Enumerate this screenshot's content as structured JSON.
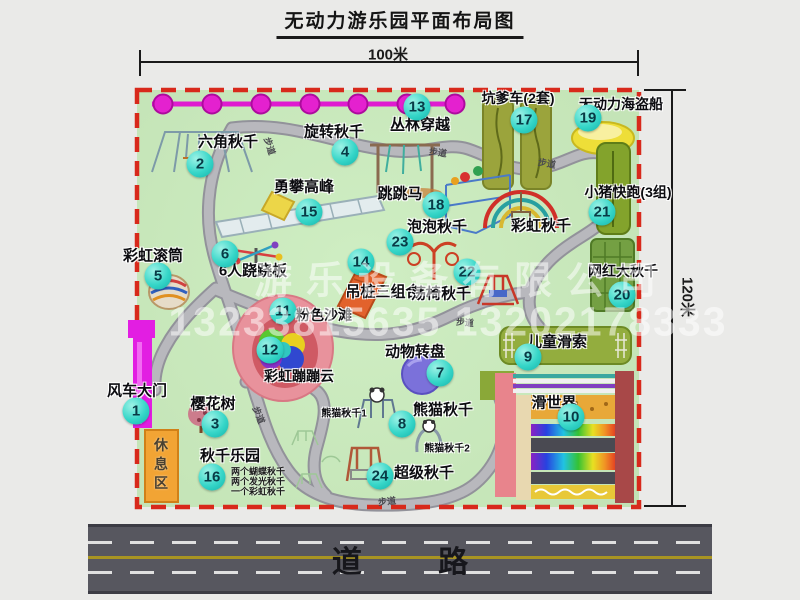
{
  "title": "无动力游乐园平面布局图",
  "dimensions": {
    "top": "100米",
    "right": "120米"
  },
  "road": {
    "label": "道 路"
  },
  "watermark": {
    "line1": "游乐设备有限公司",
    "line2": "13233815635 13202178333"
  },
  "map": {
    "path_label": "步道",
    "facilities": [
      {
        "num": "1",
        "label": "风车大门",
        "lx": 137,
        "ly": 390,
        "nx": 136,
        "ny": 411
      },
      {
        "num": "2",
        "label": "六角秋千",
        "lx": 228,
        "ly": 141,
        "nx": 200,
        "ny": 164
      },
      {
        "num": "3",
        "label": "樱花树",
        "lx": 213,
        "ly": 403,
        "nx": 215,
        "ny": 424
      },
      {
        "num": "4",
        "label": "旋转秋千",
        "lx": 334,
        "ly": 131,
        "nx": 345,
        "ny": 152
      },
      {
        "num": "5",
        "label": "彩虹滚筒",
        "lx": 153,
        "ly": 255,
        "nx": 158,
        "ny": 276
      },
      {
        "num": "6",
        "label": "6人跷跷板",
        "lx": 253,
        "ly": 270,
        "nx": 225,
        "ny": 254
      },
      {
        "num": "7",
        "label": "动物转盘",
        "lx": 415,
        "ly": 351,
        "nx": 440,
        "ny": 373
      },
      {
        "num": "8",
        "label": "熊猫秋千",
        "lx": 443,
        "ly": 409,
        "nx": 402,
        "ny": 424
      },
      {
        "num": "9",
        "label": "儿童滑索",
        "lx": 557,
        "ly": 341,
        "nx": 528,
        "ny": 357
      },
      {
        "num": "10",
        "label": "滑世界",
        "lx": 554,
        "ly": 402,
        "nx": 571,
        "ny": 417
      },
      {
        "num": "11",
        "label": "粉色沙滩",
        "lx": 324,
        "ly": 315,
        "nx": 283,
        "ny": 311,
        "fs": 14
      },
      {
        "num": "12",
        "label": "彩虹蹦蹦云",
        "lx": 299,
        "ly": 376,
        "nx": 270,
        "ny": 350,
        "fs": 14
      },
      {
        "num": "13",
        "label": "丛林穿越",
        "lx": 420,
        "ly": 124,
        "nx": 417,
        "ny": 107
      },
      {
        "num": "14",
        "label": "吊桩三组合",
        "lx": 383,
        "ly": 291,
        "nx": 361,
        "ny": 262
      },
      {
        "num": "15",
        "label": "勇攀高峰",
        "lx": 304,
        "ly": 186,
        "nx": 309,
        "ny": 212
      },
      {
        "num": "16",
        "label": "秋千乐园",
        "lx": 230,
        "ly": 455,
        "nx": 212,
        "ny": 477,
        "slx": 231,
        "sly": 471,
        "sublabels": [
          "两个蝴蝶秋千",
          "两个发光秋千",
          "一个彩虹秋千"
        ]
      },
      {
        "num": "17",
        "label": "坑爹车(2套)",
        "lx": 518,
        "ly": 98,
        "nx": 524,
        "ny": 120,
        "fs": 14
      },
      {
        "num": "18",
        "label": "跳跳马",
        "lx": 400,
        "ly": 193,
        "nx": 436,
        "ny": 205
      },
      {
        "num": "19",
        "label": "无动力海盗船",
        "lx": 621,
        "ly": 104,
        "nx": 588,
        "ny": 118,
        "fs": 14
      },
      {
        "num": "20",
        "label": "网红大秋千",
        "lx": 623,
        "ly": 271,
        "nx": 622,
        "ny": 295,
        "fs": 14
      },
      {
        "num": "21",
        "label": "小猪快跑(3组)",
        "lx": 628,
        "ly": 192,
        "nx": 602,
        "ny": 212,
        "fs": 14
      },
      {
        "num": "22",
        "label": "荡椅秋千",
        "lx": 441,
        "ly": 293,
        "nx": 467,
        "ny": 272
      },
      {
        "num": "23",
        "label": "泡泡秋千",
        "lx": 437,
        "ly": 226,
        "nx": 400,
        "ny": 242
      },
      {
        "num": "24",
        "label": "超级秋千",
        "lx": 424,
        "ly": 472,
        "nx": 380,
        "ny": 476
      },
      {
        "label": "彩虹秋千",
        "lx": 541,
        "ly": 225
      },
      {
        "label": "熊猫秋千1",
        "lx": 344,
        "ly": 412,
        "fs": 10
      },
      {
        "label": "熊猫秋千2",
        "lx": 447,
        "ly": 447,
        "fs": 10
      },
      {
        "label": "休息区",
        "lx": 161,
        "ly": 466,
        "fs": 14,
        "vertical": true
      }
    ],
    "path_labels": [
      {
        "x": 270,
        "y": 146,
        "rot": 72
      },
      {
        "x": 438,
        "y": 152,
        "rot": 8
      },
      {
        "x": 547,
        "y": 163,
        "rot": 10
      },
      {
        "x": 465,
        "y": 322,
        "rot": 5
      },
      {
        "x": 259,
        "y": 415,
        "rot": 68
      },
      {
        "x": 387,
        "y": 501,
        "rot": -6
      }
    ]
  }
}
